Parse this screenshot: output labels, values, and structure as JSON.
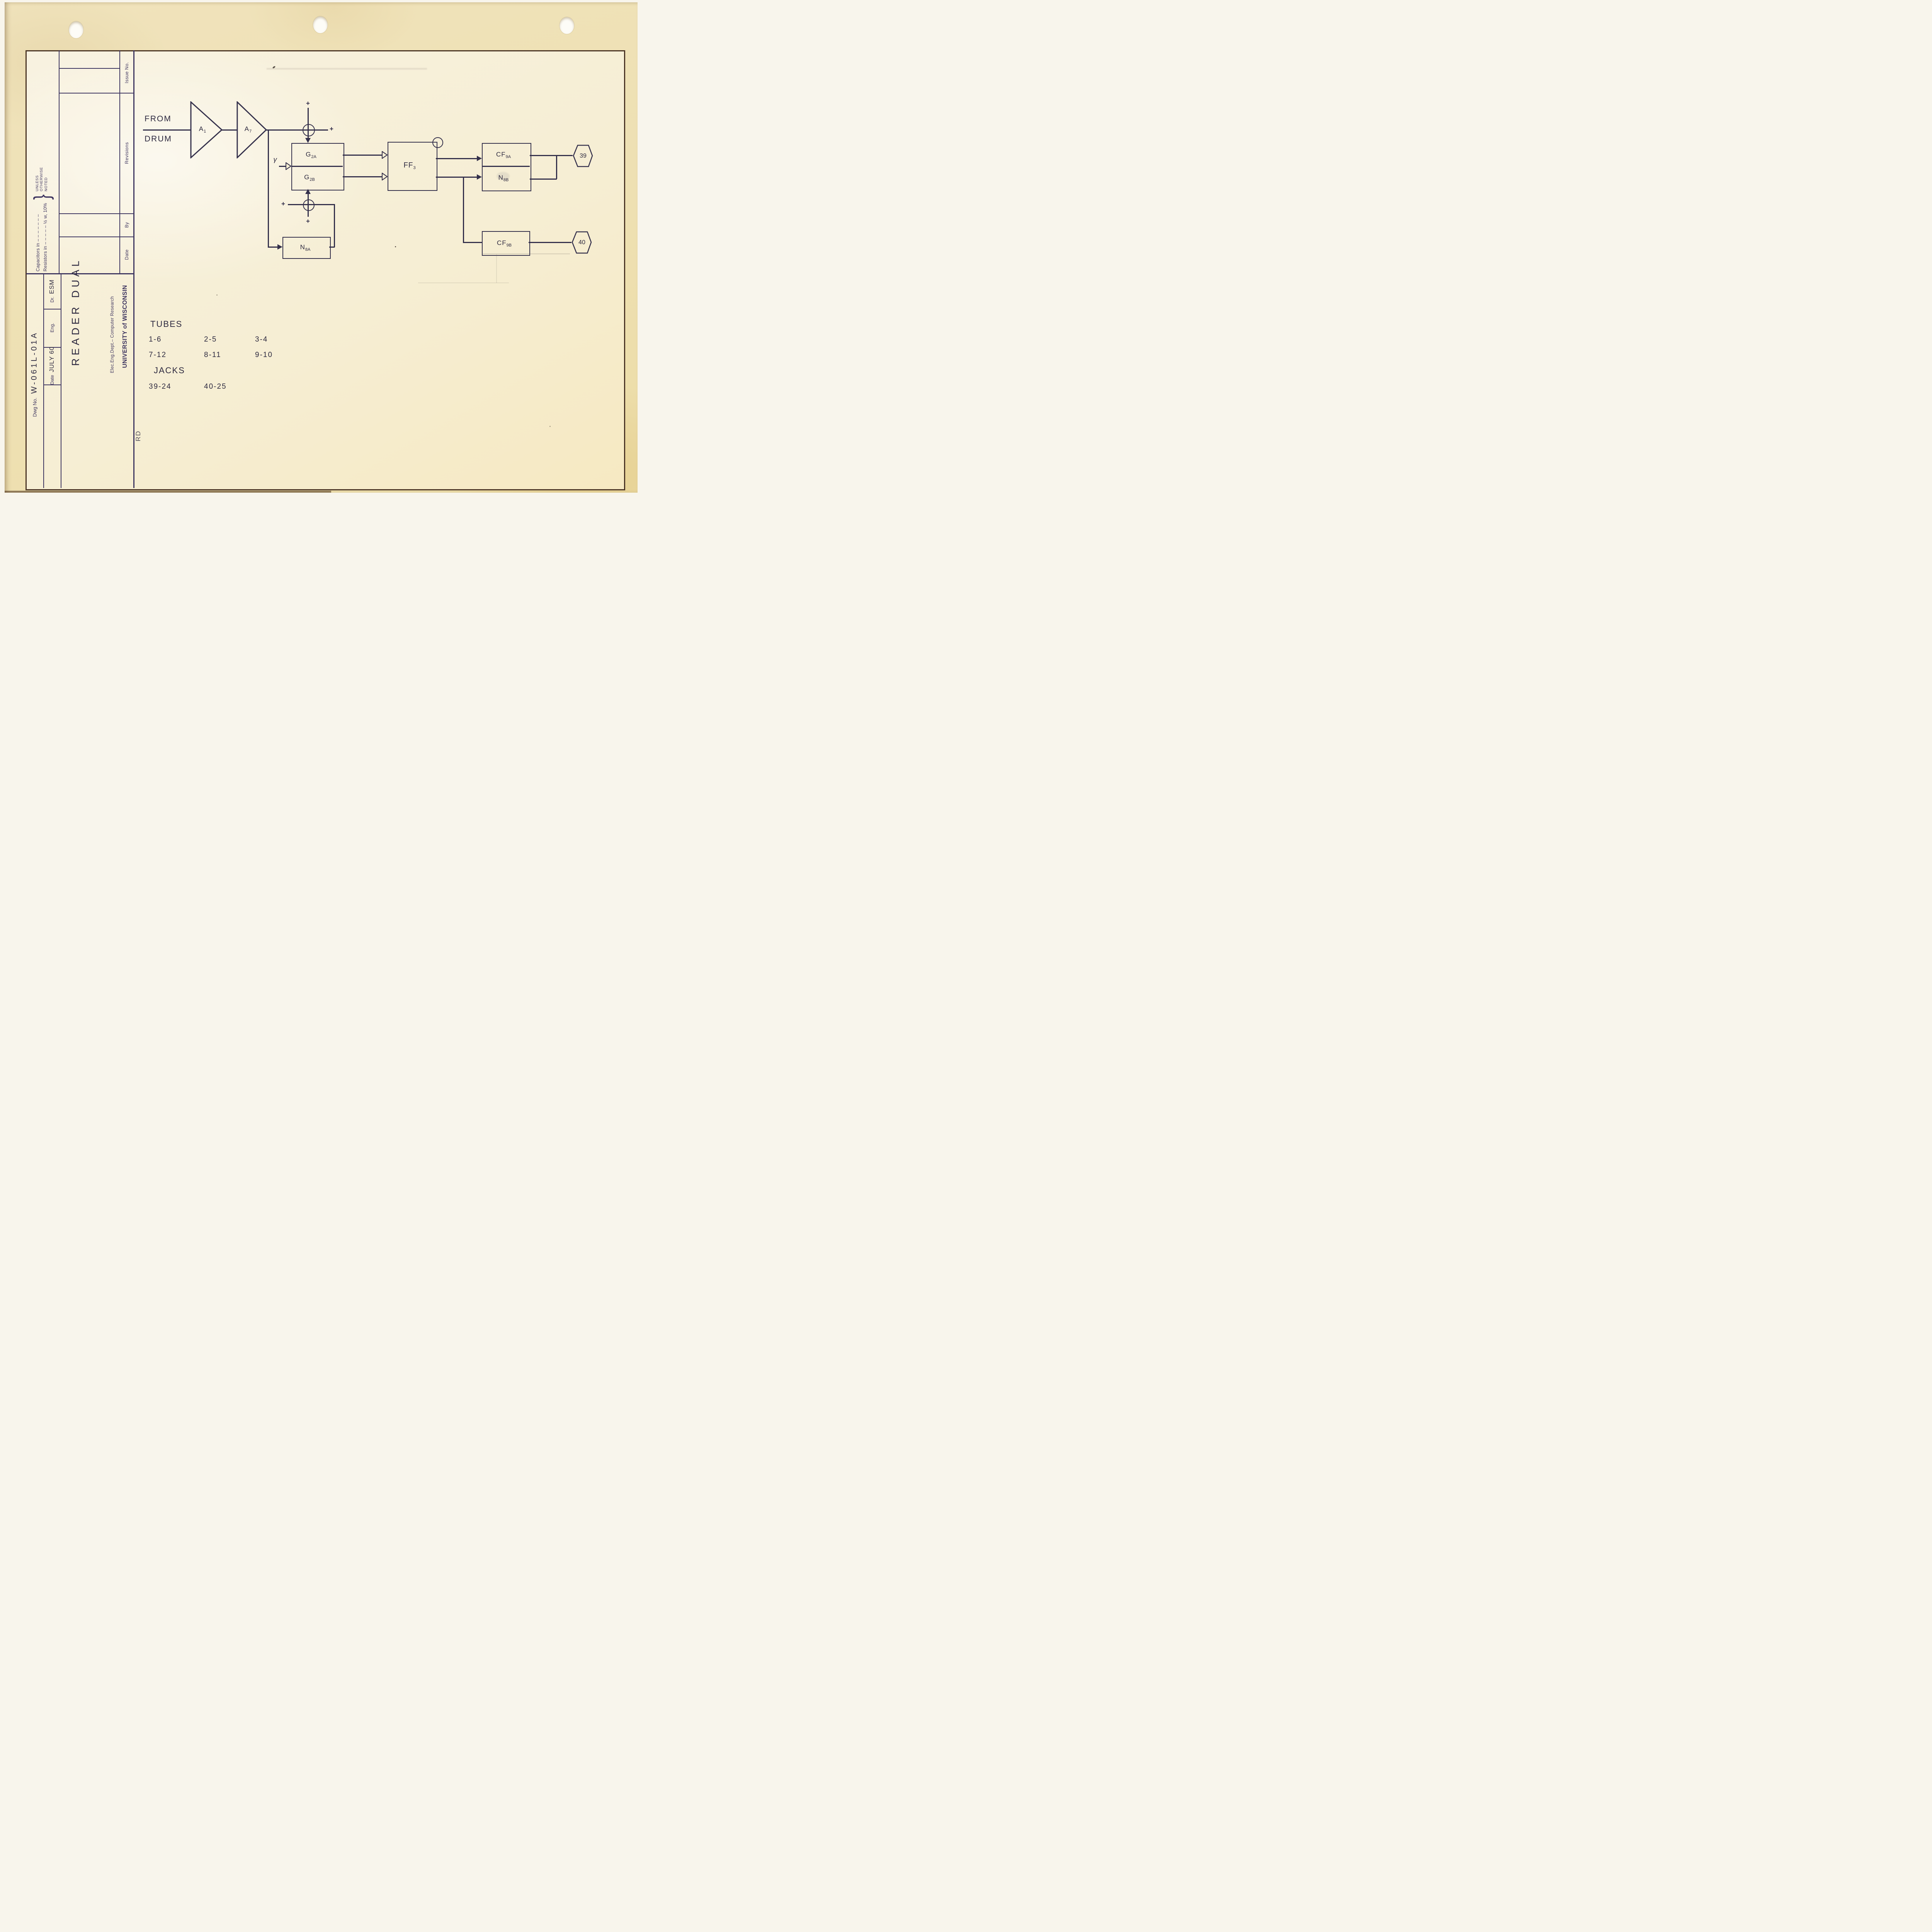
{
  "colors": {
    "frame": "#4a3424",
    "form-line": "#3d3560",
    "form-text": "#3f3660",
    "ink": "#34304b",
    "hand": "#2e2a40",
    "hole": "#fdfcf7"
  },
  "title_block": {
    "issue_no": "Issue No.",
    "revisions": "Revisions",
    "by": "By",
    "date": "Date",
    "capacitors_line": "Capacitors in – – – – – – –",
    "resistors_line": "Resistors in – – – – – ½ w, 10%",
    "unless_brace": "}",
    "unless_line1": "UNLESS",
    "unless_line2": "OTHERWISE",
    "unless_line3": "NOTED",
    "dwg_no_label": "Dwg No.",
    "dwg_no_value": "W-061L-01A",
    "dr_label": "Dr.",
    "dr_value": "ESM",
    "eng_label": "Eng.",
    "date_label": "Date",
    "date_value": "JULY 60",
    "drawing_title": "READER DUAL",
    "org_line1": "UNIVERSITY of WISCONSIN",
    "org_line2": "Elec.Eng.Dept.– Computer Research",
    "corner_code": "RD"
  },
  "schematic": {
    "source_line1": "FROM",
    "source_line2": "DRUM",
    "amp1": {
      "main": "A",
      "sub": "1"
    },
    "amp2": {
      "main": "A",
      "sub": "7"
    },
    "gate_a": {
      "main": "G",
      "sub": "2A"
    },
    "gate_b": {
      "main": "G",
      "sub": "2B"
    },
    "ff": {
      "main": "FF",
      "sub": "3"
    },
    "cf9a": {
      "main": "CF",
      "sub": "9A"
    },
    "n8b": {
      "main": "N",
      "sub": "8B"
    },
    "n8a": {
      "main": "N",
      "sub": "8A"
    },
    "cf9b": {
      "main": "CF",
      "sub": "9B"
    },
    "jack39": "39",
    "jack40": "40",
    "gamma": "γ",
    "plus": "+"
  },
  "notes": {
    "tubes_heading": "TUBES",
    "tubes_rows": [
      [
        "1-6",
        "2-5",
        "3-4"
      ],
      [
        "7-12",
        "8-11",
        "9-10"
      ]
    ],
    "jacks_heading": "JACKS",
    "jacks_row": [
      "39-24",
      "40-25"
    ]
  }
}
